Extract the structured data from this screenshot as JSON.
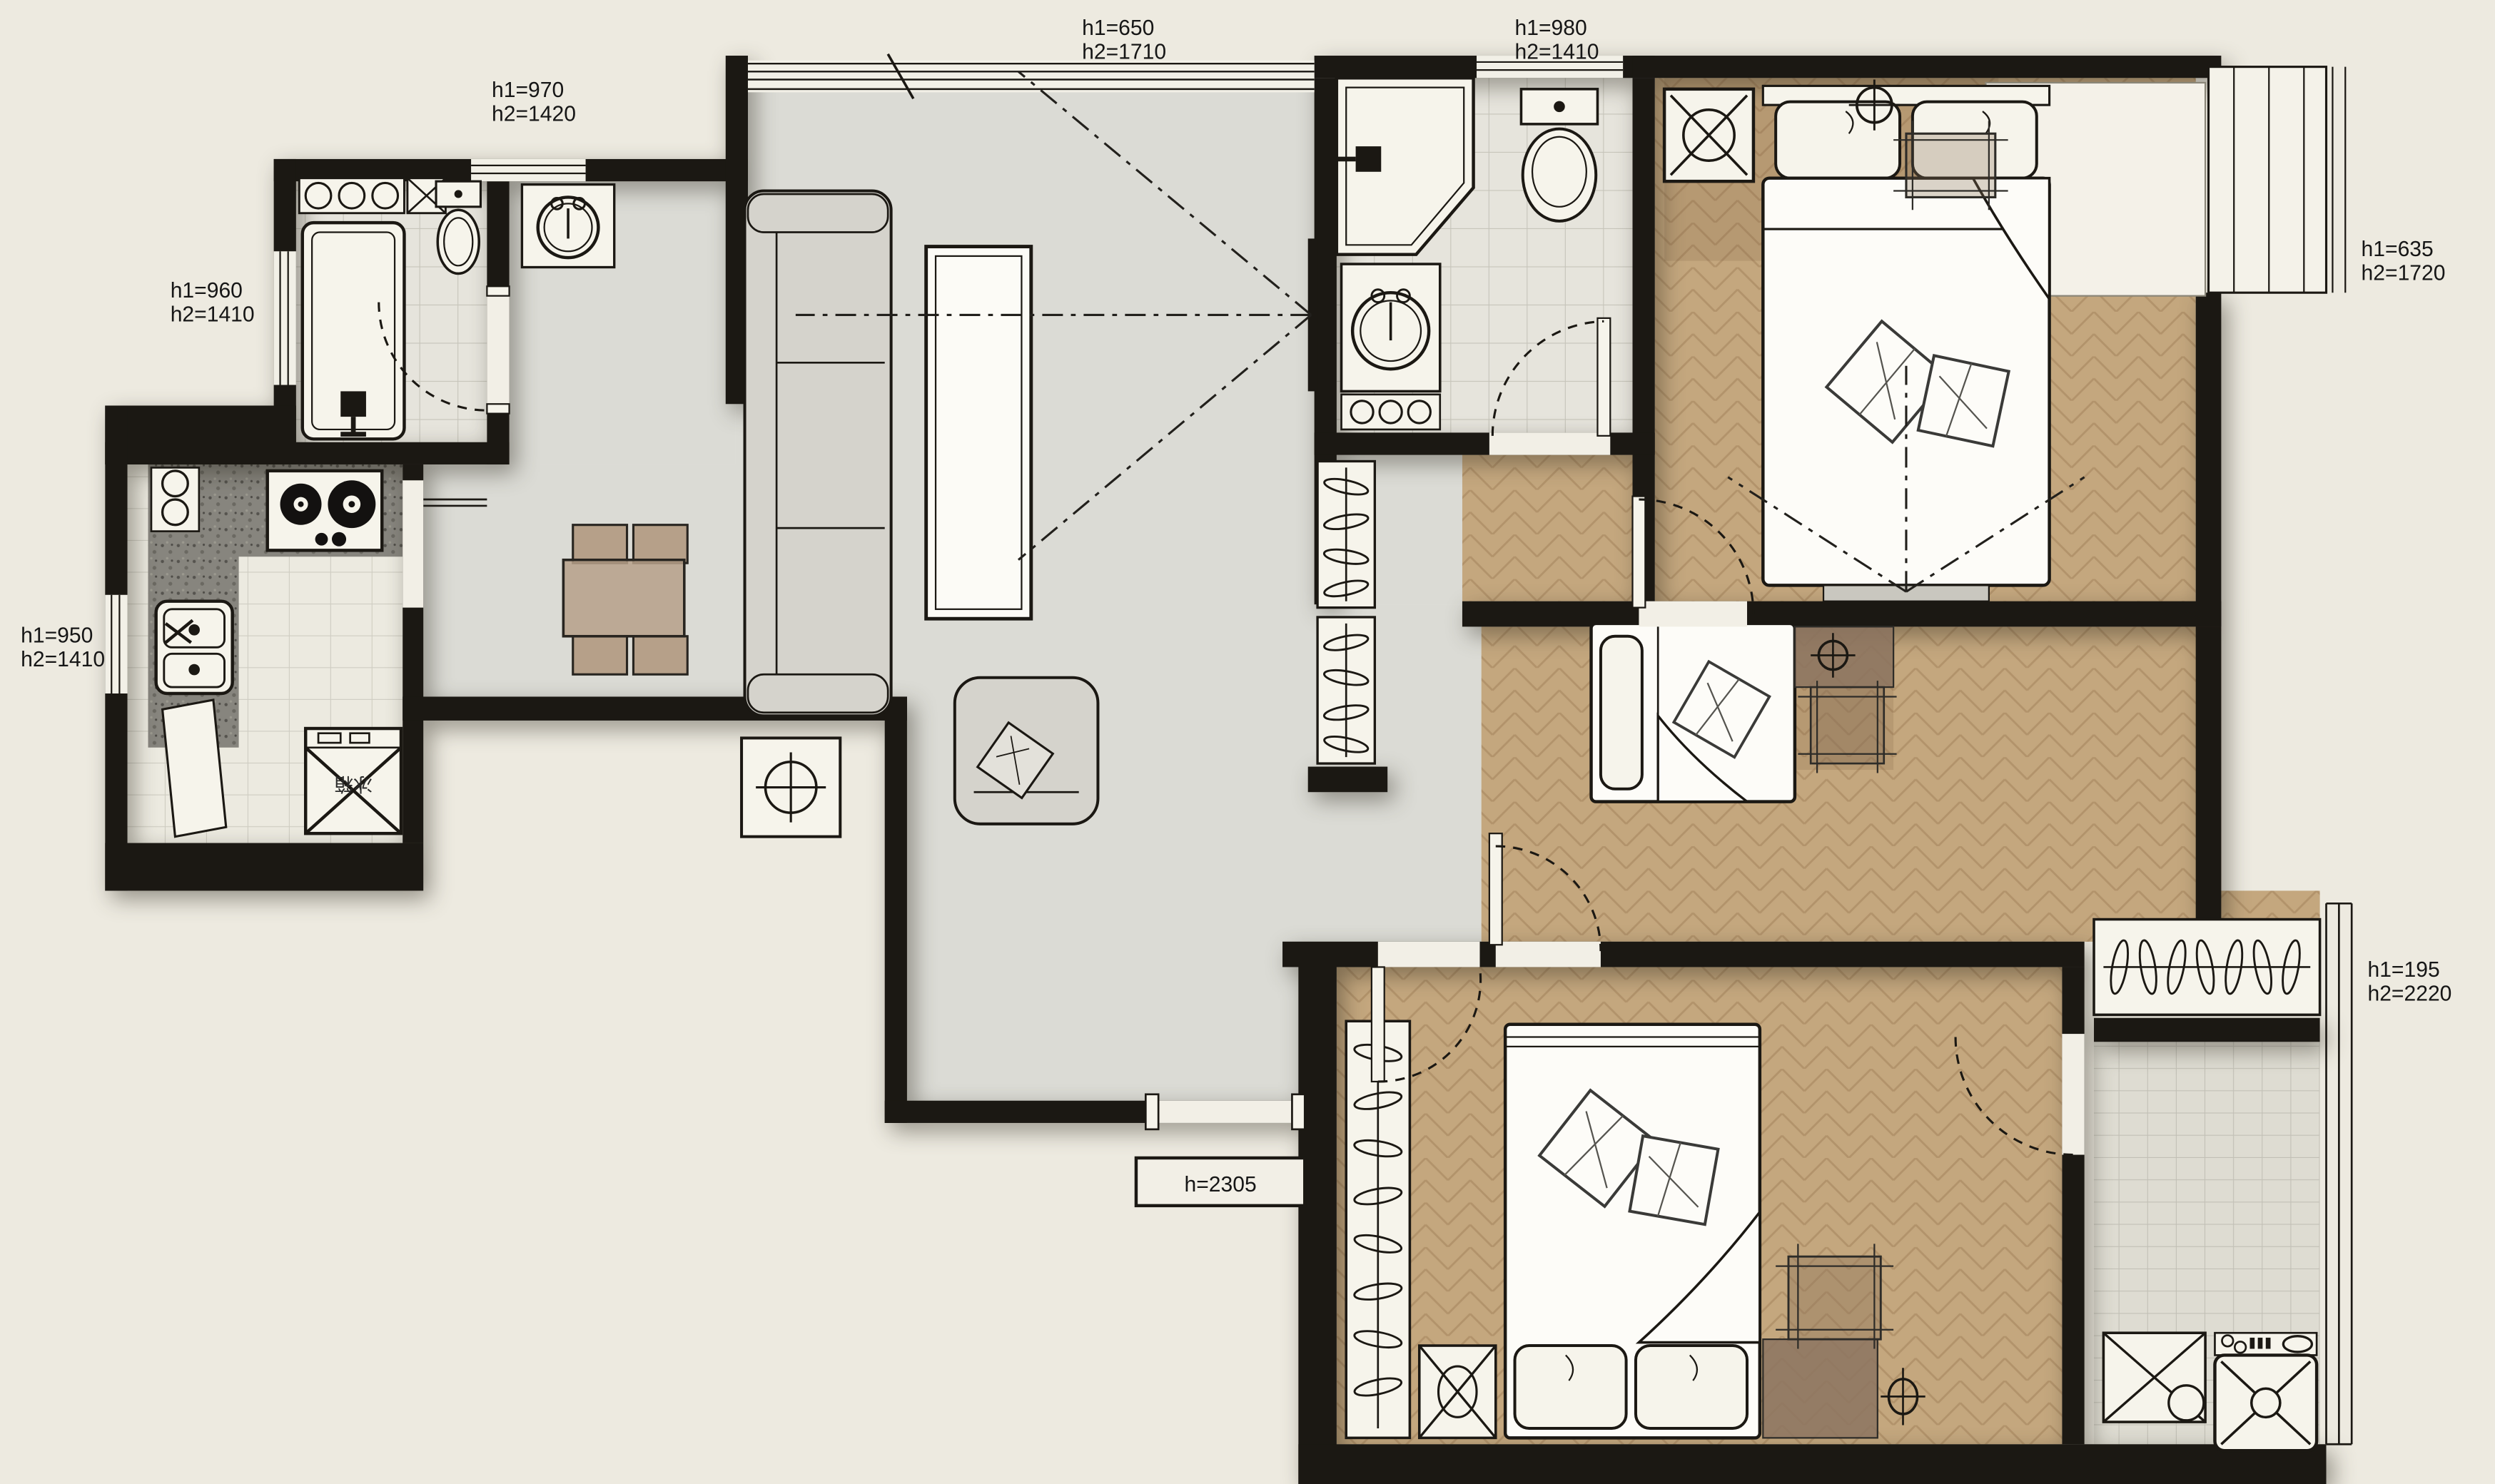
{
  "plan": {
    "type": "apartment-floor-plan",
    "labels": {
      "win_living": {
        "l1": "h1=650",
        "l2": "h2=1710"
      },
      "win_bath2": {
        "l1": "h1=980",
        "l2": "h2=1410"
      },
      "win_entry": {
        "l1": "h1=970",
        "l2": "h2=1420"
      },
      "win_bath1": {
        "l1": "h1=960",
        "l2": "h2=1410"
      },
      "win_kitchen": {
        "l1": "h1=950",
        "l2": "h2=1410"
      },
      "win_master": {
        "l1": "h1=635",
        "l2": "h2=1720"
      },
      "win_balcony": {
        "l1": "h1=195",
        "l2": "h2=2220"
      },
      "door_entry": {
        "l1": "h=2305"
      },
      "fridge": {
        "l1": "冰箱"
      }
    },
    "colors": {
      "background": "#EDEAE0",
      "wall": "#1B1813",
      "marble_floor": "#DBDBD5",
      "wood_floor": "#C4A77E",
      "wood_dark": "#8C7460",
      "tile_floor": "#E6E4DC",
      "granite": "#84827B",
      "fixture_white": "#F6F4EB",
      "furniture_gray": "#D5D3CC",
      "line": "#1B1813"
    }
  }
}
